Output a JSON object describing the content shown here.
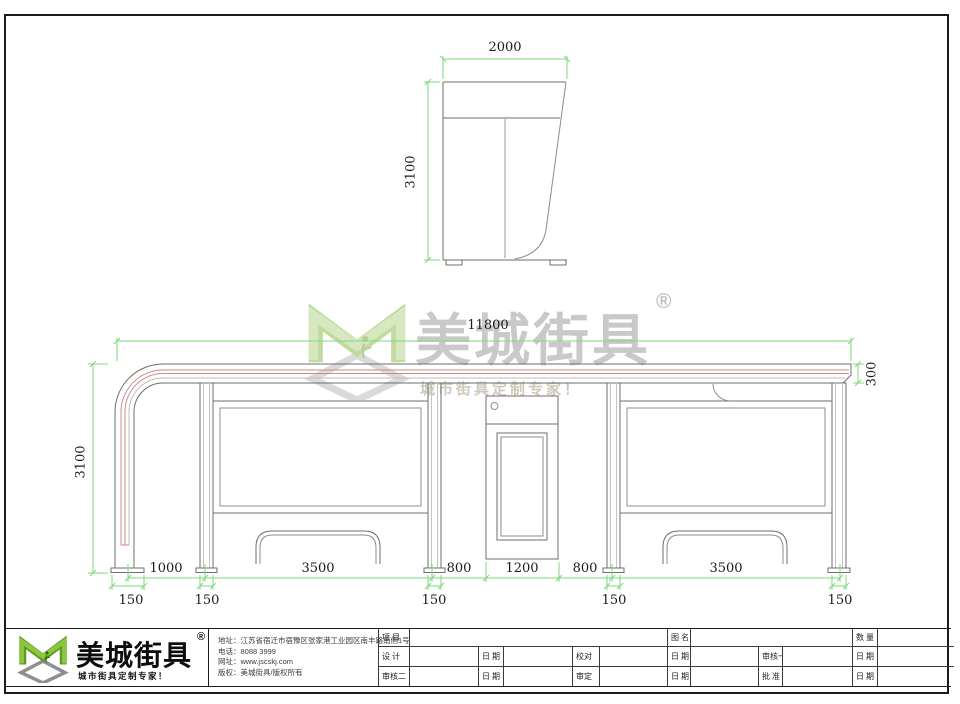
{
  "watermark": {
    "brand": "美城街具",
    "registered": "®",
    "slogan": "城市街具定制专家！"
  },
  "dimensions": {
    "side_view": {
      "width": "2000",
      "height": "3100"
    },
    "elevation": {
      "total_length": "11800",
      "height": "3100",
      "roof_height": "300"
    },
    "bottom_row1": [
      "1000",
      "3500",
      "800",
      "1200",
      "800",
      "3500"
    ],
    "bottom_row2": [
      "150",
      "150",
      "150",
      "150",
      "150"
    ]
  },
  "footer": {
    "logo": {
      "brand": "美城街具",
      "registered": "®",
      "slogan": "城市街具定制专家！"
    },
    "info": [
      {
        "label": "地址：",
        "value": "江苏省宿迁市宿豫区张家港工业园区南丰路南侧1号"
      },
      {
        "label": "电话：",
        "value": "8088 3999"
      },
      {
        "label": "网址：",
        "value": "www.jscskj.com"
      },
      {
        "label": "版权：",
        "value": "美城街具/版权所有"
      }
    ],
    "titleblock": {
      "row1": [
        "项 目",
        "图 名",
        "数 量"
      ],
      "row2": [
        "设 计",
        "日 期",
        "校对",
        "日 期",
        "审核一",
        "日 期"
      ],
      "row3": [
        "审核二",
        "日 期",
        "审定",
        "日 期",
        "批 准",
        "日 期"
      ]
    }
  },
  "colors": {
    "dimension_green": "#7fd87f",
    "roof_red": "#cc8a8a",
    "logo_green": "#79b62f"
  }
}
